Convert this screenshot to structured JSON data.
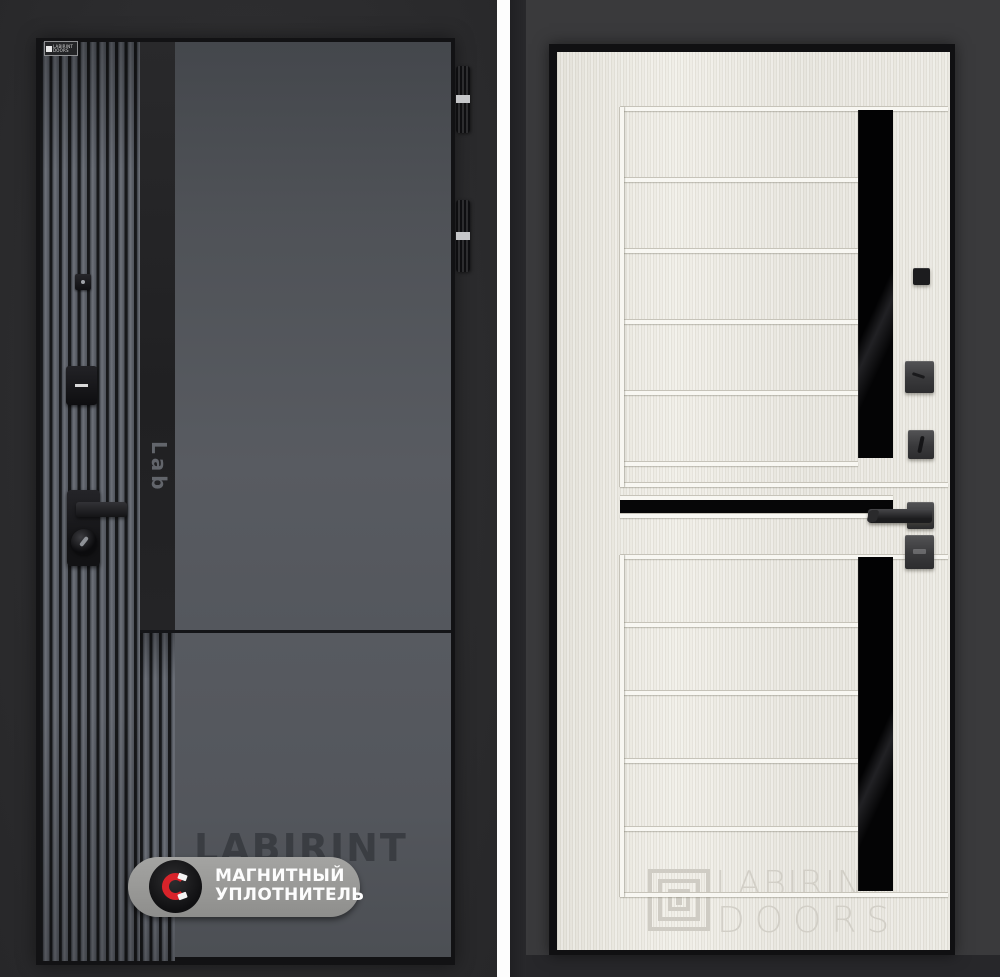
{
  "page": {
    "background": "#2d2d2f",
    "divider_color": "#fdfdfd",
    "description": "Product photo pair: front (dark graphite) and back (sandal white) sides of a LABIRINT entry door"
  },
  "left_panel": {
    "door_color": "#54575d",
    "stripe_color": "#232325",
    "brand_plate": {
      "brand": "LABIRINT",
      "sub": "DOORS"
    },
    "series_logo": "Lab",
    "watermark": "LABIRINT",
    "badge": {
      "line1": "МАГНИТНЫЙ",
      "line2": "УПЛОТНИТЕЛЬ",
      "pill_color": "#9b9b99",
      "magnet_color": "#d8232a"
    }
  },
  "right_panel": {
    "leaf_color": "#ebe9e2",
    "glass_color": "#060607",
    "frame_color": "#3a3a3c",
    "watermark_brand": "LABIRINT",
    "watermark_sub": "DOORS"
  }
}
